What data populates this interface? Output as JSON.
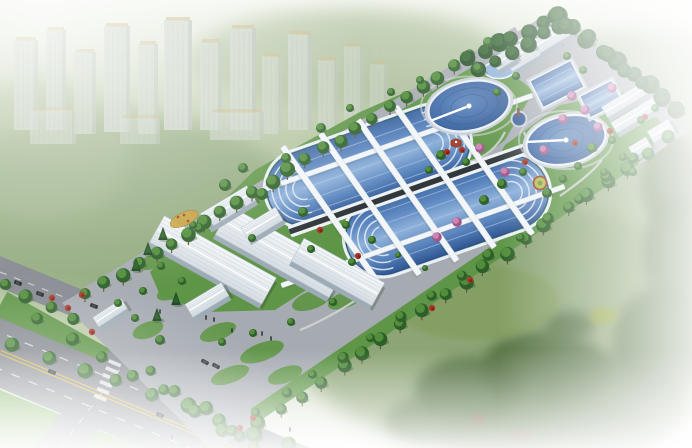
{
  "scene": {
    "title": "aerial-rendering-wastewater-treatment-plant",
    "description": "Bird's-eye architectural rendering of a wastewater treatment plant campus: a diagonal rectangular site with two large oblong aeration basins crossed by white walkways, two round clarifiers with radial bridges, rectangular pools, white ribbed industrial sheds, tree-lined boundaries, gardens with pink flowering trees, an entrance gate and road intersection at lower left, hazy city high-rises at upper left and soft green fields fading to white around the edges."
  },
  "colors": {
    "bg_top": "#f3f6ee",
    "bg_mid1": "#b5c5a0",
    "bg_mid2": "#a7bb92",
    "bg_mid3": "#c2cfae",
    "bg_bottom": "#f6f8f4",
    "field_green": "#8fa87b",
    "field_green2": "#88a171",
    "field_dark": "#4e6a3b",
    "field_light": "#7e9a54",
    "tower": "#ccd5c9",
    "tower_shade": "#b2bdb2",
    "tower_roof": "#c9b98a",
    "tower_window": "#b8c3b8",
    "tree_dark": "#2d6029",
    "tree_light": "#55923d",
    "tree_deep": "#1e4a20",
    "trunk": "#6b5139",
    "pink_dark": "#a05688",
    "pink_light": "#cf8ab8",
    "shrub_red": "#a63b28",
    "shrub_red_dark": "#7c2417",
    "lawn": "#5f9547",
    "lawn_light": "#79ad58",
    "site_pavement": "#a6abb2",
    "road_asphalt": "#84888f",
    "gravel": "#d2d6da",
    "yellow_line": "#d9ba3e",
    "white_line": "#e9ebed",
    "water_dark": "#2f5691",
    "water_mid": "#5d87c0",
    "water_light": "#8fb2da",
    "water_edge": "#2a4f86",
    "pool_rim": "#e9f0f7",
    "lane_line": "#a9c6e3",
    "channel_dark": "#30383b",
    "channel_white": "#eef2f5",
    "clar_hi": "#5b86bd",
    "clar_mid": "#3f6aa6",
    "clar_low": "#2f5691",
    "apron": "#cbd1d7",
    "bld_roof": "#f4f7f9",
    "bld_roof_dark": "#d5dde3",
    "bld_rib": "#c6d1d9",
    "bld_side": "#9dabb6",
    "shadow": "rgba(45,62,40,0.30)",
    "car_dark": "#23272b",
    "car_roof": "#3c4248",
    "pavilion_red": "#a8402e",
    "parterre_gold": "#c8a23b",
    "parterre_ring": "#b5c156",
    "fountain": "#2f5693",
    "haze": "#ffffff"
  },
  "site": {
    "outline": [
      [
        62,
        303
      ],
      [
        549,
        13
      ],
      [
        689,
        131
      ],
      [
        213,
        452
      ]
    ],
    "lawn_main": [
      [
        150,
        272
      ],
      [
        255,
        170
      ],
      [
        360,
        112
      ],
      [
        470,
        64
      ],
      [
        545,
        72
      ],
      [
        505,
        140
      ],
      [
        430,
        200
      ],
      [
        350,
        262
      ],
      [
        275,
        310
      ],
      [
        205,
        312
      ],
      [
        160,
        295
      ]
    ],
    "lawn_right": [
      [
        505,
        145
      ],
      [
        560,
        105
      ],
      [
        622,
        92
      ],
      [
        665,
        125
      ],
      [
        645,
        158
      ],
      [
        570,
        205
      ],
      [
        505,
        235
      ],
      [
        470,
        250
      ],
      [
        455,
        230
      ],
      [
        480,
        190
      ]
    ],
    "plaza_top": [
      [
        497,
        62
      ],
      [
        518,
        34
      ],
      [
        566,
        26
      ],
      [
        602,
        50
      ],
      [
        578,
        84
      ],
      [
        530,
        88
      ]
    ],
    "garden_strip": {
      "from": [
        255,
        415
      ],
      "to": [
        635,
        158
      ],
      "width": 15
    },
    "perimeter_road_nw": {
      "from": [
        84,
        295
      ],
      "to": [
        518,
        32
      ],
      "width": 12
    },
    "lawn_pockets": [
      [
        188,
        252,
        22,
        11
      ],
      [
        252,
        292,
        24,
        10
      ],
      [
        312,
        300,
        21,
        9
      ],
      [
        218,
        332,
        19,
        8
      ],
      [
        172,
        292,
        16,
        7
      ],
      [
        262,
        352,
        23,
        9
      ],
      [
        305,
        242,
        16,
        7
      ],
      [
        152,
        262,
        14,
        7
      ],
      [
        345,
        300,
        18,
        8
      ],
      [
        230,
        375,
        20,
        8
      ],
      [
        285,
        375,
        18,
        8
      ],
      [
        148,
        330,
        16,
        8
      ]
    ]
  },
  "basins": [
    {
      "cx": 368,
      "cy": 166,
      "len": 210,
      "wid": 74,
      "angle": -19.3
    },
    {
      "cx": 447,
      "cy": 215,
      "len": 210,
      "wid": 74,
      "angle": -19.3
    }
  ],
  "channel": {
    "cx": 407.5,
    "cy": 190.5,
    "len": 250,
    "angle": -19.3
  },
  "walkways_perp": {
    "angle": 55,
    "len": 172,
    "wid": 6,
    "centers": [
      [
        332,
        217
      ],
      [
        370,
        204
      ],
      [
        407.5,
        190.5
      ],
      [
        445,
        177
      ],
      [
        483,
        164
      ]
    ]
  },
  "walkways_long": {
    "angle": -19.3,
    "len": 300,
    "wid": 5,
    "centers": [
      [
        391,
        145
      ],
      [
        423,
        236
      ]
    ]
  },
  "clarifiers": [
    {
      "cx": 469,
      "cy": 106,
      "rx": 41,
      "ry": 24.5,
      "arm_deg": 165
    },
    {
      "cx": 566,
      "cy": 140,
      "rx": 40,
      "ry": 24,
      "arm_deg": 195
    }
  ],
  "small_pool": {
    "cx": 499,
    "cy": 70,
    "rx": 15,
    "ry": 8.5
  },
  "rect_pools": [
    {
      "cx": 557,
      "cy": 84,
      "len": 46,
      "wid": 30,
      "angle": -27
    },
    {
      "cx": 601,
      "cy": 99,
      "len": 36,
      "wid": 24,
      "angle": -27
    }
  ],
  "fountain": {
    "cx": 519,
    "cy": 119,
    "r": 6.5
  },
  "pavilion": {
    "cx": 456,
    "cy": 143,
    "r": 6
  },
  "parterre": {
    "cx": 184,
    "cy": 219,
    "rx": 15,
    "ry": 6.5,
    "angle": -25
  },
  "ring_garden": {
    "cx": 540,
    "cy": 183,
    "r": 6.5
  },
  "buildings": [
    {
      "cx": 213,
      "cy": 260,
      "len": 128,
      "wid": 30,
      "angle": 29
    },
    {
      "cx": 280,
      "cy": 252,
      "len": 130,
      "wid": 32,
      "angle": 29
    },
    {
      "cx": 338,
      "cy": 272,
      "len": 92,
      "wid": 26,
      "angle": 29
    },
    {
      "cx": 207,
      "cy": 300,
      "len": 42,
      "wid": 15,
      "angle": -31
    },
    {
      "cx": 228,
      "cy": 207,
      "len": 54,
      "wid": 17,
      "angle": -31
    },
    {
      "cx": 262,
      "cy": 224,
      "len": 40,
      "wid": 15,
      "angle": -31
    },
    {
      "cx": 530,
      "cy": 47,
      "len": 56,
      "wid": 24,
      "angle": -31
    },
    {
      "cx": 552,
      "cy": 36,
      "len": 38,
      "wid": 17,
      "angle": -31
    },
    {
      "cx": 504,
      "cy": 59,
      "len": 22,
      "wid": 13,
      "angle": -31
    },
    {
      "cx": 627,
      "cy": 99,
      "len": 52,
      "wid": 12,
      "angle": -31
    },
    {
      "cx": 637,
      "cy": 114,
      "len": 54,
      "wid": 12,
      "angle": -31
    },
    {
      "cx": 661,
      "cy": 131,
      "len": 24,
      "wid": 13,
      "angle": -31
    },
    {
      "cx": 640,
      "cy": 147,
      "len": 20,
      "wid": 11,
      "angle": -31
    },
    {
      "cx": 110,
      "cy": 313,
      "len": 34,
      "wid": 11,
      "angle": -33
    }
  ],
  "roads": {
    "avenue": [
      [
        0,
        318
      ],
      [
        310,
        448
      ],
      [
        143,
        448
      ],
      [
        0,
        388
      ]
    ],
    "gate_road": [
      [
        140,
        312
      ],
      [
        176,
        326
      ],
      [
        84,
        448
      ],
      [
        34,
        448
      ]
    ],
    "left_road": [
      [
        0,
        256
      ],
      [
        122,
        306
      ],
      [
        112,
        332
      ],
      [
        0,
        288
      ]
    ],
    "green_sw": [
      [
        0,
        390
      ],
      [
        143,
        448
      ],
      [
        0,
        448
      ]
    ],
    "median_line": {
      "from": [
        0,
        305
      ],
      "to": [
        261,
        450
      ],
      "width": 30
    },
    "yellow_center": {
      "from": [
        0,
        352
      ],
      "to": [
        232,
        448
      ]
    },
    "dash_offsets": [
      -18,
      16
    ],
    "crosswalk": {
      "cx": 106,
      "cy": 384,
      "bars": 6,
      "step": 7.5,
      "bar_len": 13,
      "bar_wid": 3.6,
      "road_angle": 22.7,
      "step_angle": 112.7
    },
    "gate_dash": {
      "from": [
        156,
        322
      ],
      "to": [
        60,
        448
      ]
    },
    "left_dash": {
      "from": [
        0,
        272
      ],
      "to": [
        117,
        318
      ]
    }
  },
  "city_towers": [
    [
      14,
      40,
      24,
      90,
      0.75
    ],
    [
      46,
      30,
      20,
      100,
      0.8
    ],
    [
      74,
      52,
      22,
      82,
      0.7
    ],
    [
      104,
      26,
      26,
      106,
      0.85
    ],
    [
      138,
      44,
      20,
      90,
      0.75
    ],
    [
      164,
      20,
      28,
      110,
      0.9
    ],
    [
      200,
      42,
      22,
      88,
      0.8
    ],
    [
      230,
      28,
      26,
      102,
      0.85
    ],
    [
      262,
      56,
      20,
      78,
      0.7
    ],
    [
      288,
      34,
      24,
      96,
      0.8
    ],
    [
      318,
      60,
      20,
      72,
      0.65
    ],
    [
      344,
      46,
      20,
      76,
      0.6
    ],
    [
      370,
      64,
      18,
      58,
      0.5
    ],
    [
      30,
      110,
      46,
      34,
      0.6
    ],
    [
      210,
      112,
      54,
      28,
      0.6
    ],
    [
      120,
      118,
      40,
      26,
      0.55
    ]
  ],
  "field_blobs": [
    [
      120,
      210,
      180,
      95,
      "#8fa87b",
      0.85
    ],
    [
      520,
      330,
      230,
      130,
      "#88a171",
      0.9
    ],
    [
      640,
      120,
      120,
      90,
      "#90a87e",
      0.7
    ],
    [
      350,
      60,
      160,
      50,
      "#9db289",
      0.6
    ],
    [
      40,
      150,
      90,
      70,
      "#a3b78f",
      0.6
    ]
  ],
  "bg_trees": [
    [
      470,
      392,
      55,
      35
    ],
    [
      545,
      372,
      65,
      42
    ],
    [
      612,
      402,
      75,
      48
    ],
    [
      662,
      342,
      48,
      55
    ],
    [
      682,
      252,
      38,
      58
    ],
    [
      505,
      432,
      65,
      28
    ],
    [
      432,
      422,
      48,
      24
    ],
    [
      585,
      432,
      75,
      28
    ],
    [
      672,
      182,
      30,
      48
    ],
    [
      570,
      325,
      25,
      14
    ]
  ],
  "bg_accents": [
    [
      475,
      302,
      85,
      38,
      "#7e9a54",
      0.55
    ],
    [
      604,
      316,
      14,
      9,
      "#93a430",
      0.7
    ],
    [
      522,
      438,
      10,
      8,
      "#7a4a35",
      0.6
    ],
    [
      478,
      420,
      8,
      7,
      "#7a4a35",
      0.6
    ]
  ],
  "tree_rows": [
    {
      "from": [
        88,
        295
      ],
      "to": [
        472,
        56
      ],
      "n": 24,
      "r": 6.5,
      "v": "alley"
    },
    {
      "from": [
        470,
        58
      ],
      "to": [
        556,
        16
      ],
      "n": 7,
      "r": 8,
      "v": "forest"
    },
    {
      "from": [
        556,
        16
      ],
      "to": [
        678,
        110
      ],
      "n": 9,
      "r": 8.5,
      "v": "forest"
    },
    {
      "from": [
        480,
        68
      ],
      "to": [
        560,
        26
      ],
      "n": 6,
      "r": 7,
      "v": "forest"
    },
    {
      "from": [
        566,
        24
      ],
      "to": [
        664,
        100
      ],
      "n": 6,
      "r": 7,
      "v": "forest"
    },
    {
      "from": [
        668,
        138
      ],
      "to": [
        240,
        438
      ],
      "n": 22,
      "r": 6.5,
      "v": "alley"
    },
    {
      "from": [
        15,
        345
      ],
      "to": [
        290,
        445
      ],
      "n": 9,
      "r": 7,
      "v": "round"
    },
    {
      "from": [
        40,
        318
      ],
      "to": [
        255,
        448
      ],
      "n": 8,
      "r": 6,
      "v": "round"
    },
    {
      "from": [
        5,
        282
      ],
      "to": [
        75,
        320
      ],
      "n": 4,
      "r": 6,
      "v": "round"
    },
    {
      "from": [
        255,
        415
      ],
      "to": [
        635,
        158
      ],
      "n": 14,
      "r": 5,
      "v": "round"
    },
    {
      "from": [
        150,
        372
      ],
      "to": [
        230,
        430
      ],
      "n": 4,
      "r": 6,
      "v": "round"
    }
  ],
  "trees_scatter": [
    [
      225,
      185,
      6
    ],
    [
      243,
      168,
      5
    ],
    [
      262,
      194,
      6
    ],
    [
      286,
      158,
      5
    ],
    [
      199,
      228,
      5
    ],
    [
      303,
      212,
      5
    ],
    [
      321,
      128,
      5
    ],
    [
      350,
      108,
      4
    ],
    [
      391,
      92,
      4
    ],
    [
      420,
      80,
      4
    ],
    [
      441,
      155,
      5
    ],
    [
      466,
      162,
      4
    ],
    [
      429,
      170,
      4
    ],
    [
      484,
      200,
      5
    ],
    [
      502,
      184,
      5
    ],
    [
      523,
      172,
      4
    ],
    [
      547,
      193,
      5
    ],
    [
      563,
      179,
      4
    ],
    [
      592,
      148,
      5
    ],
    [
      612,
      140,
      4
    ],
    [
      578,
      166,
      4
    ],
    [
      623,
      157,
      4
    ],
    [
      641,
      120,
      4
    ],
    [
      655,
      108,
      4
    ],
    [
      604,
      172,
      4
    ],
    [
      633,
      172,
      4
    ],
    [
      488,
      42,
      5
    ],
    [
      478,
      68,
      5
    ],
    [
      516,
      76,
      4
    ],
    [
      567,
      56,
      4
    ],
    [
      583,
      70,
      4
    ],
    [
      497,
      92,
      4
    ],
    [
      193,
      225,
      4
    ],
    [
      252,
      238,
      4
    ],
    [
      311,
      249,
      4
    ],
    [
      352,
      262,
      4
    ],
    [
      333,
      302,
      4
    ],
    [
      291,
      322,
      4
    ],
    [
      253,
      333,
      4
    ],
    [
      222,
      342,
      4
    ],
    [
      182,
      281,
      4
    ],
    [
      161,
      266,
      4
    ],
    [
      143,
      291,
      4
    ],
    [
      118,
      303,
      4
    ],
    [
      346,
      225,
      4
    ],
    [
      372,
      240,
      4
    ],
    [
      398,
      255,
      3
    ],
    [
      425,
      268,
      3
    ],
    [
      160,
      340,
      5
    ],
    [
      135,
      318,
      4
    ]
  ],
  "pines": [
    [
      148,
      252
    ],
    [
      163,
      237
    ],
    [
      136,
      268
    ],
    [
      176,
      302
    ],
    [
      157,
      318
    ]
  ],
  "pink_trees": [
    [
      572,
      96
    ],
    [
      585,
      110
    ],
    [
      563,
      119
    ],
    [
      598,
      127
    ],
    [
      612,
      88
    ],
    [
      544,
      150
    ],
    [
      505,
      172
    ],
    [
      457,
      222
    ],
    [
      437,
      237
    ],
    [
      480,
      148
    ]
  ],
  "red_shrubs": [
    [
      193,
      214
    ],
    [
      320,
      230
    ],
    [
      462,
      150
    ],
    [
      447,
      152
    ],
    [
      610,
      131
    ],
    [
      645,
      117
    ],
    [
      240,
      428
    ],
    [
      253,
      418
    ],
    [
      92,
      332
    ],
    [
      575,
      143
    ],
    [
      525,
      162
    ],
    [
      52,
      298
    ],
    [
      68,
      308
    ],
    [
      470,
      280
    ],
    [
      432,
      308
    ],
    [
      358,
      256
    ],
    [
      82,
      295
    ]
  ],
  "paths": [
    "M505,178 C520,168 532,150 524,132",
    "M468,162 C486,158 498,146 505,132",
    "M560,196 C575,185 590,175 602,160",
    "M170,238 C186,228 198,234 194,248 C190,258 176,258 170,250",
    "M300,330 C330,318 356,300 378,286"
  ],
  "cars": [
    [
      18,
      283,
      21
    ],
    [
      40,
      294,
      21
    ],
    [
      94,
      306,
      21
    ],
    [
      205,
      362,
      29
    ],
    [
      216,
      366,
      29
    ],
    [
      52,
      372,
      23
    ],
    [
      160,
      415,
      23
    ]
  ],
  "people": [
    [
      160,
      312
    ],
    [
      206,
      318
    ],
    [
      232,
      331
    ],
    [
      262,
      334
    ],
    [
      271,
      339
    ],
    [
      172,
      438
    ],
    [
      290,
      430
    ],
    [
      214,
      320
    ]
  ]
}
